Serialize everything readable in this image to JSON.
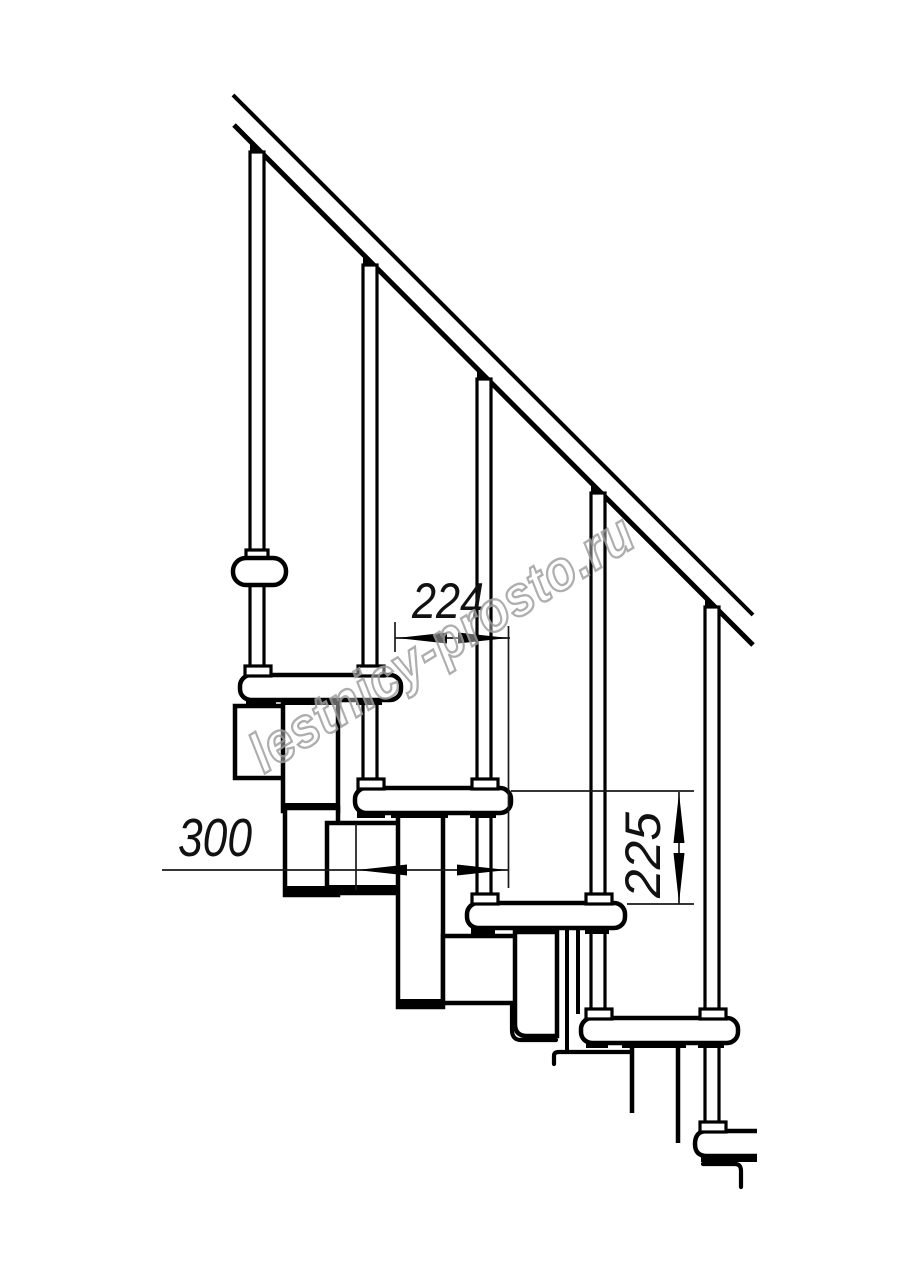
{
  "drawing": {
    "background": "#ffffff",
    "line_color": "#000000",
    "watermark": {
      "text": "lestnicy-prosto.ru",
      "color": "#a0a0a0"
    },
    "dimensions": [
      {
        "label": "224",
        "orientation": "horizontal"
      },
      {
        "label": "300",
        "orientation": "horizontal"
      },
      {
        "label": "225",
        "orientation": "vertical"
      }
    ],
    "parts": {
      "handrail": "handrail",
      "baluster_count": 5,
      "tread_count": 5,
      "bracket": "upper-bracket",
      "modules": "step-modules"
    }
  }
}
